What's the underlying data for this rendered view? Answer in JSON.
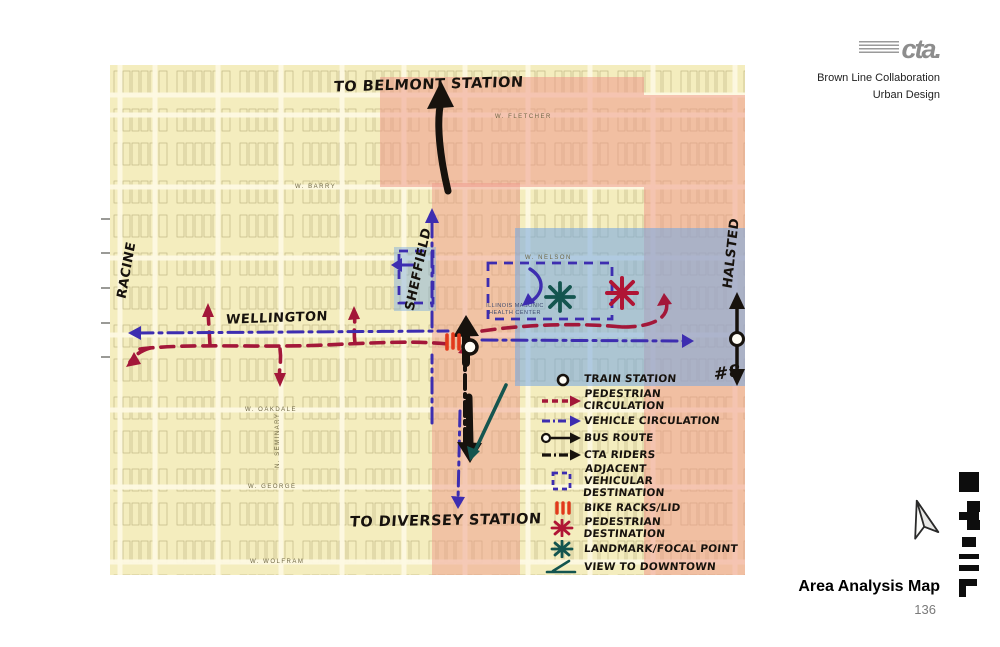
{
  "header": {
    "logo": "cta.",
    "program": "Brown Line Collaboration",
    "department": "Urban Design"
  },
  "footer": {
    "title": "Area Analysis Map",
    "page_number": "136"
  },
  "map": {
    "annotations": {
      "to_belmont": "TO BELMONT STATION",
      "to_diversey": "TO DIVERSEY STATION",
      "wellington": "WELLINGTON",
      "racine": "RACINE",
      "sheffield": "SHEFFIELD",
      "halsted": "HALSTED",
      "bus_route_number": "#8"
    },
    "base_labels": {
      "fletcher": "W. FLETCHER",
      "barry": "W. BARRY",
      "nelson": "W. NELSON",
      "oakdale": "W. OAKDALE",
      "george": "W. GEORGE",
      "wolfram": "W. WOLFRAM",
      "seminary": "N. SEMINARY",
      "health_center": "ILLINOIS MASONIC HEALTH CENTER"
    },
    "legend": {
      "items": [
        {
          "symbol": "train-station",
          "label": "TRAIN STATION"
        },
        {
          "symbol": "pedestrian-circulation",
          "label": "PEDESTRIAN CIRCULATION"
        },
        {
          "symbol": "vehicle-circulation",
          "label": "VEHICLE CIRCULATION"
        },
        {
          "symbol": "bus-route",
          "label": "BUS ROUTE"
        },
        {
          "symbol": "cta-riders",
          "label": "CTA RIDERS"
        },
        {
          "symbol": "adjacent-vehicular-destination",
          "label": "ADJACENT VEHICULAR DESTINATION"
        },
        {
          "symbol": "bike-racks",
          "label": "BIKE RACKS/LID"
        },
        {
          "symbol": "pedestrian-destination",
          "label": "PEDESTRIAN DESTINATION"
        },
        {
          "symbol": "landmark-focal-point",
          "label": "LANDMARK/FOCAL POINT"
        },
        {
          "symbol": "view-to-downtown",
          "label": "VIEW TO DOWNTOWN"
        }
      ]
    },
    "colors": {
      "residential_yellow": "#f4edbe",
      "corridor_pink": "#ee998a",
      "institutional_blue": "#78a8e0",
      "pedestrian_red": "#a31739",
      "vehicle_blue": "#3d2db0",
      "annotation_black": "#17120d",
      "landmark_teal": "#14554f",
      "bike_rack_red": "#e2391b"
    }
  }
}
